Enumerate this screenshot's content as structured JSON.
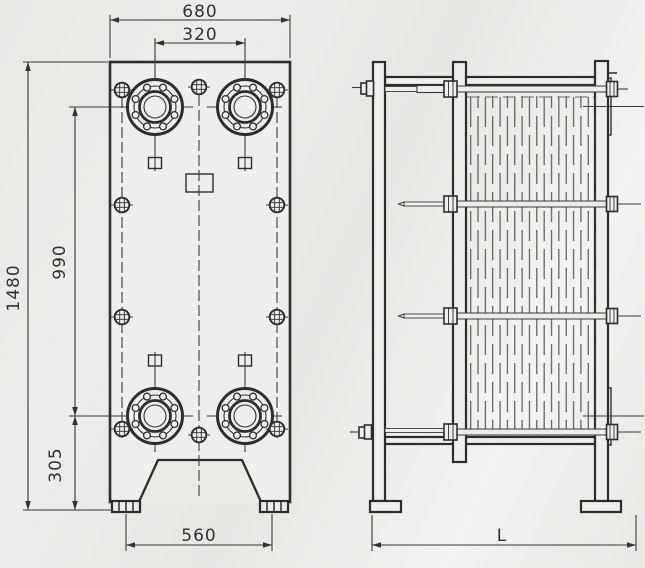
{
  "title": "Plate heat exchanger dimensional drawing",
  "front_view": {
    "dimensions": {
      "overall_width": "680",
      "port_spacing_horizontal": "320",
      "frame_height": "1480",
      "port_spacing_vertical": "990",
      "port_height_from_base": "305",
      "foot_spacing": "560"
    }
  },
  "side_view": {
    "dimensions": {
      "overall_length": "L"
    }
  },
  "colors": {
    "line": "#2e2d2b",
    "background": "#eae9e6",
    "paper_highlight": "#f4f3f1"
  }
}
